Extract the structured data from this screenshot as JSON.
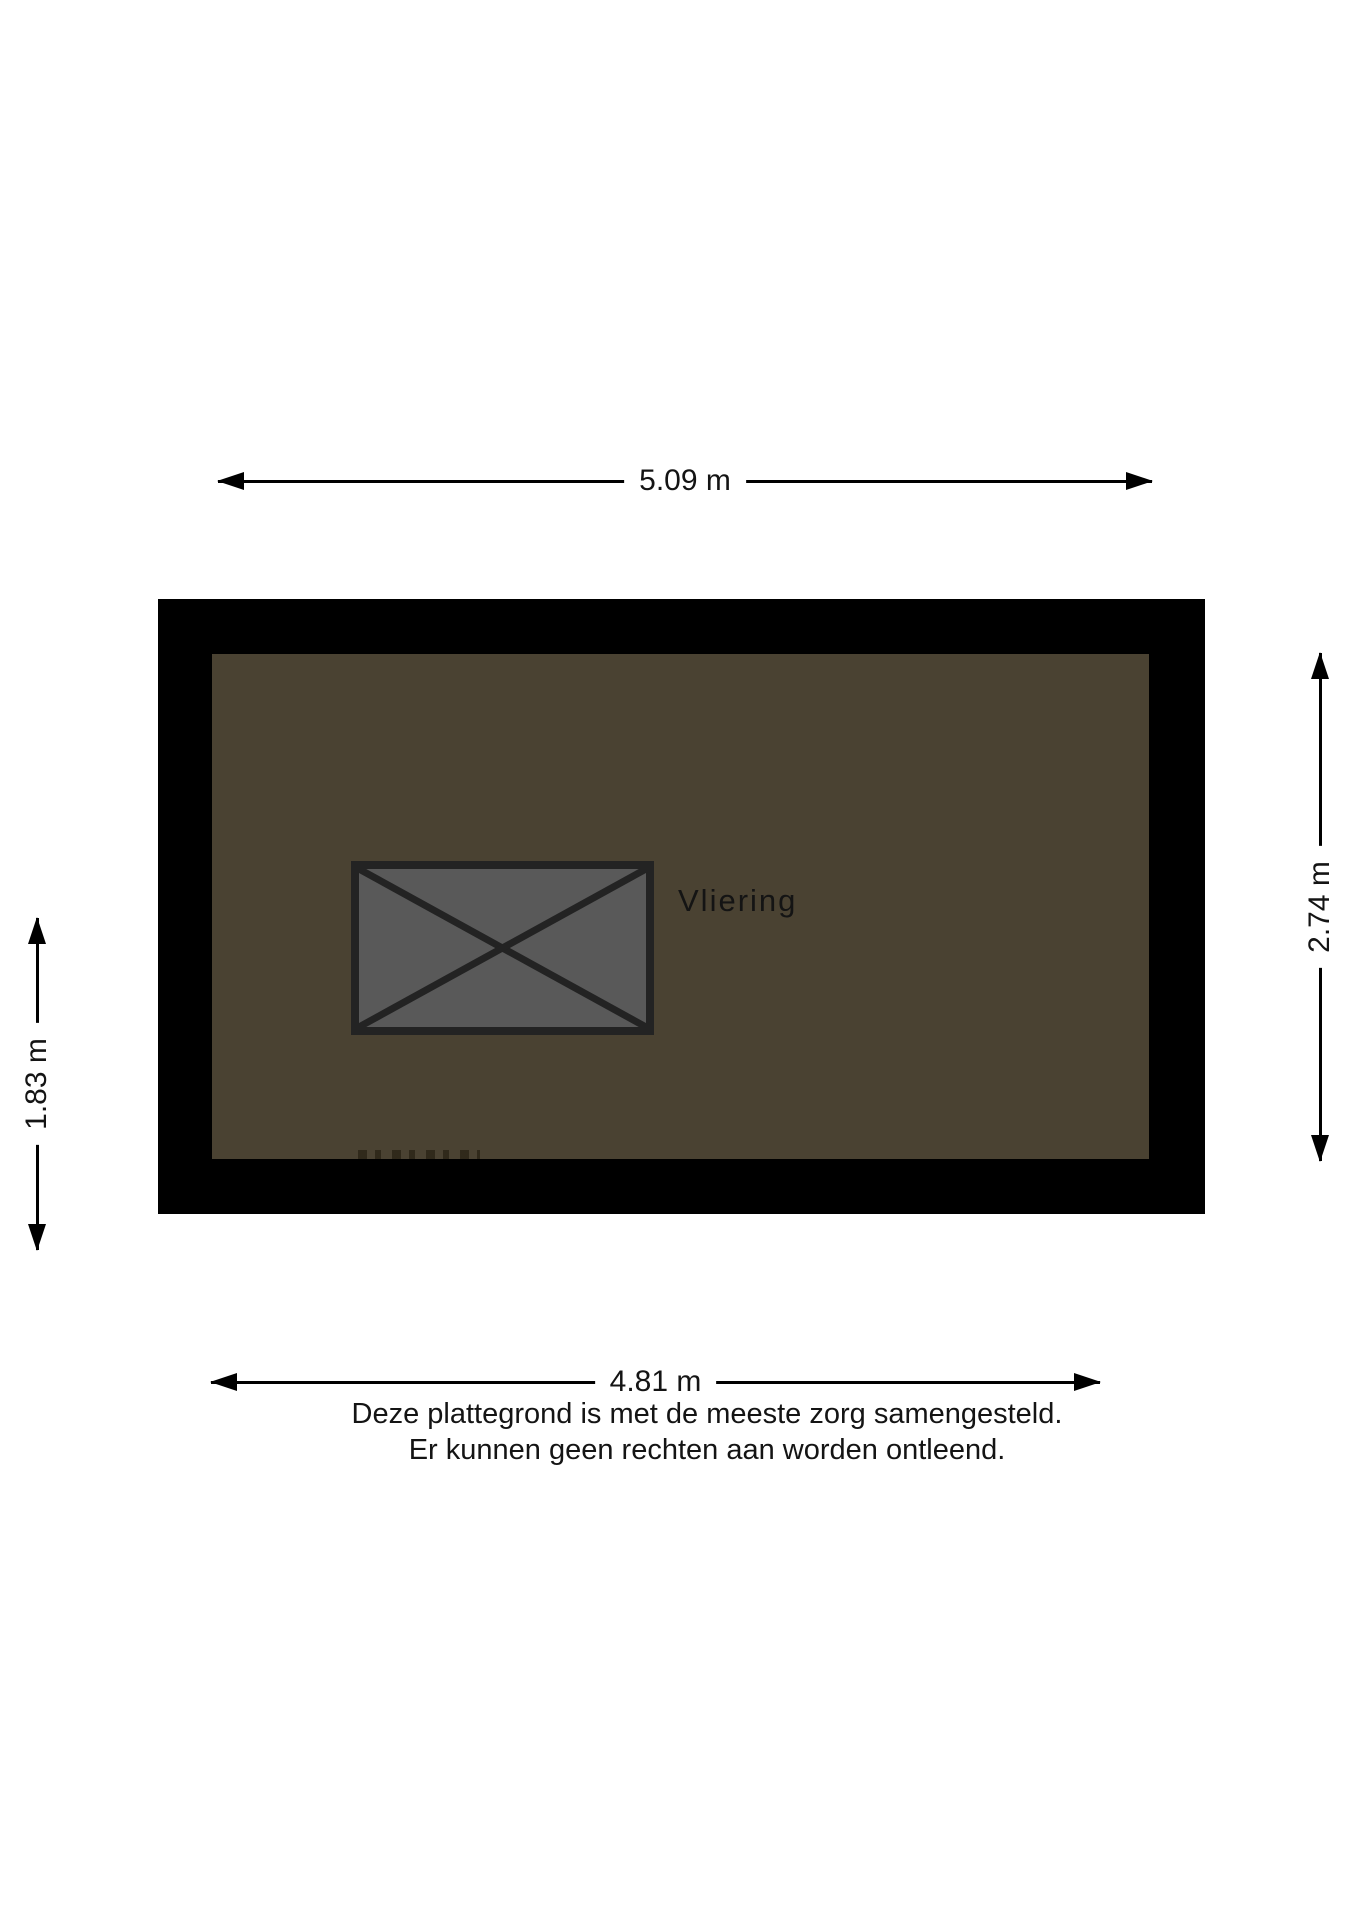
{
  "room": {
    "label": "Vliering"
  },
  "dimensions": {
    "top": "5.09 m",
    "bottom": "4.81 m",
    "left": "1.83 m",
    "right": "2.74 m"
  },
  "disclaimer": {
    "line1": "Deze plattegrond is met de meeste zorg samengesteld.",
    "line2": "Er kunnen geen rechten aan worden ontleend."
  },
  "colors": {
    "wall": "#000000",
    "floor": "#4a4232",
    "hatch_fill": "#595959",
    "hatch_line": "#232323",
    "dimension": "#000000",
    "text": "#141414",
    "background": "#ffffff"
  }
}
